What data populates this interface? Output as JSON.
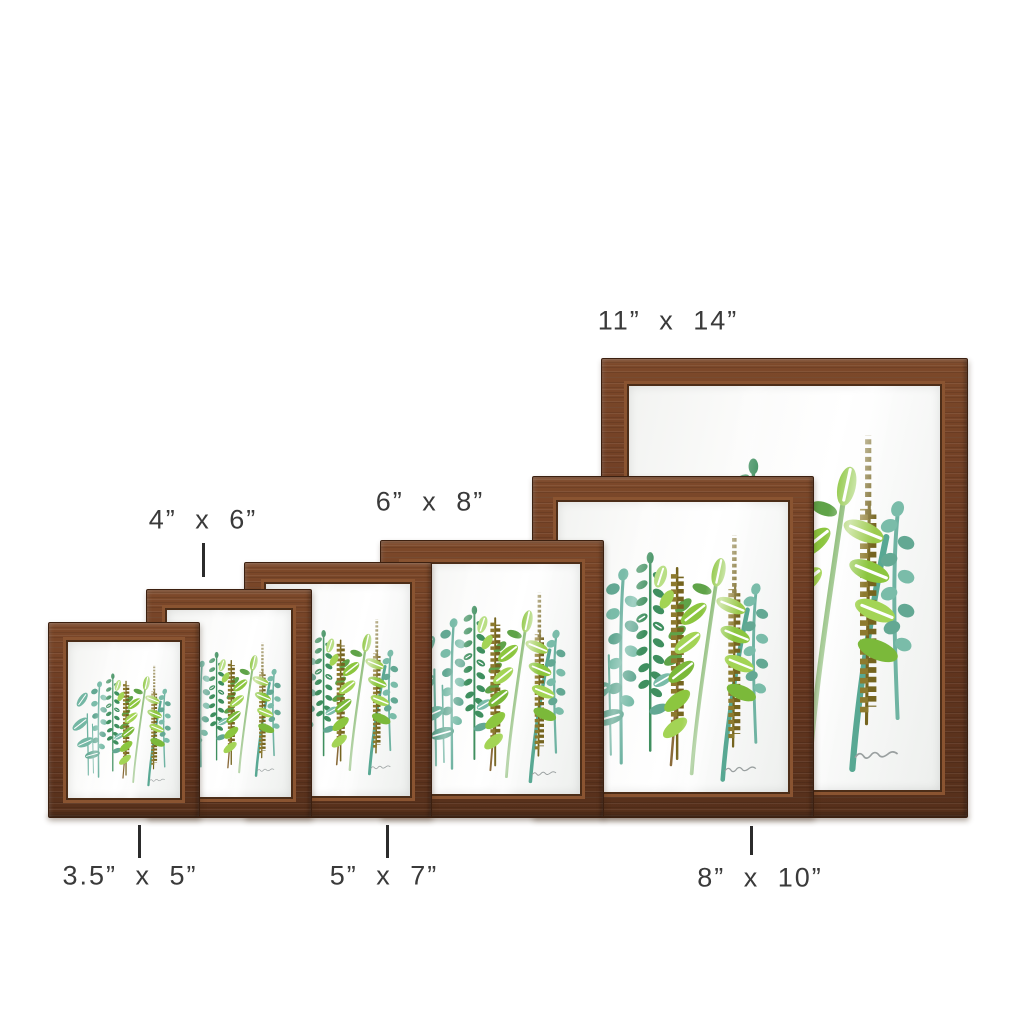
{
  "page": {
    "background": "#ffffff"
  },
  "product_size_chart": {
    "frames": [
      {
        "name": "3.5x5",
        "size_label": "3.5” x 5”"
      },
      {
        "name": "4x6",
        "size_label": "4” x 6”"
      },
      {
        "name": "5x7",
        "size_label": "5” x 7”"
      },
      {
        "name": "6x8",
        "size_label": "6” x 8”"
      },
      {
        "name": "8x10",
        "size_label": "8” x 10”"
      },
      {
        "name": "11x14",
        "size_label": "11” x 14”"
      }
    ]
  },
  "palette": {
    "wood": "#683821",
    "wood_light": "#7d492a",
    "wood_dark": "#3c2010",
    "wood_lip": "#8a5431",
    "label_text": "#3a3a3a",
    "tick": "#2b2b2b",
    "art_bg": "#fbfbfa",
    "stem_teal": "#6fb3a2",
    "stem_teal2": "#58a893",
    "stem_green": "#6aa84f",
    "stem_brown": "#8a6b3a",
    "teal_leaf": "#7abca9",
    "teal_leaf_dark": "#63a893",
    "teal_big": "#74b7a4",
    "fern_green": "#3f8f5f",
    "green_mid": "#5fa348",
    "olive": "#8d7a2e",
    "olive_dark": "#75641f",
    "lime": "#8cc63f",
    "lime_mid": "#a3d455",
    "lime_dark": "#7bb93a",
    "lime_soft": "#9ccb4d",
    "lime_light": "#b9df86",
    "vein": "#ffffff",
    "signature": "#9aa0a0"
  }
}
